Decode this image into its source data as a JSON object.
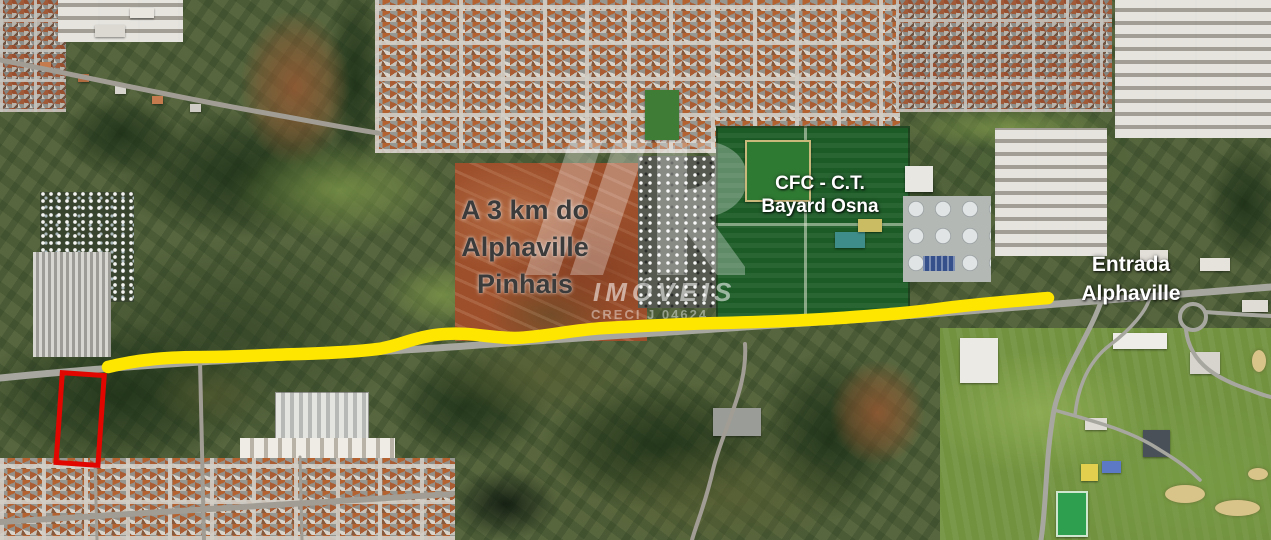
{
  "map": {
    "colors": {
      "route": "#ffe600",
      "marker": "#e10600",
      "labelDark": "#3b3b3b",
      "labelLight": "#ffffff"
    },
    "labels": {
      "distance": {
        "line1": "A 3 km do",
        "line2": "Alphaville",
        "line3": "Pinhais"
      },
      "cfc": {
        "line1": "CFC - C.T.",
        "line2": "Bayard Osna"
      },
      "entrada": {
        "line1": "Entrada",
        "line2": "Alphaville"
      }
    },
    "watermark": {
      "brand": "IMÓVEIS",
      "creci": "CRECI J 04624"
    }
  }
}
